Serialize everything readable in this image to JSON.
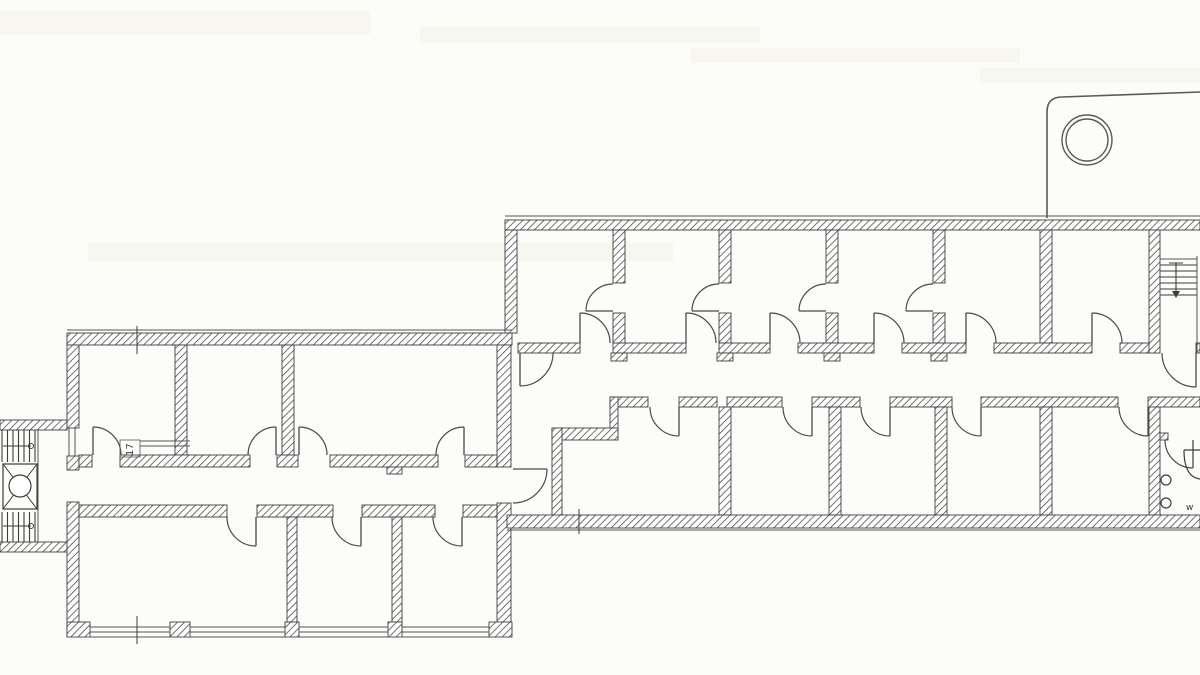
{
  "document": {
    "type": "architectural-floor-plan",
    "description": "Scanned black-and-white building floor plan with two office wings, central corridors, door swings, two stairwells, an elevator, a WC and an entrance canopy with column"
  },
  "labels": {
    "room_number": "17",
    "wc": "w"
  },
  "colors": {
    "background": "#fcfcf9",
    "wall_stroke": "#3d3d3d",
    "hatch": "#4d4d4d",
    "door": "#4a4a4a",
    "thin_line": "#555555",
    "canopy": "#5a5a5a",
    "streak": "#f3f1e8"
  },
  "plan": {
    "canvas": {
      "w": 1200,
      "h": 675
    },
    "streaks": [
      [
        0,
        10,
        370,
        24
      ],
      [
        420,
        26,
        340,
        16
      ],
      [
        88,
        243,
        585,
        18
      ],
      [
        690,
        48,
        330,
        15
      ],
      [
        980,
        68,
        220,
        14
      ]
    ],
    "walls": [
      [
        67,
        333,
        445,
        12
      ],
      [
        67,
        345,
        12,
        83
      ],
      [
        67,
        456,
        12,
        14
      ],
      [
        67,
        502,
        12,
        135
      ],
      [
        497,
        345,
        14,
        122
      ],
      [
        497,
        503,
        14,
        134
      ],
      [
        175,
        345,
        12,
        110
      ],
      [
        282,
        345,
        12,
        110
      ],
      [
        79,
        455,
        13,
        12
      ],
      [
        120,
        455,
        130,
        12
      ],
      [
        277,
        455,
        21,
        12
      ],
      [
        330,
        455,
        108,
        12
      ],
      [
        465,
        455,
        32,
        12
      ],
      [
        387,
        467,
        15,
        7
      ],
      [
        79,
        505,
        148,
        12
      ],
      [
        257,
        505,
        76,
        12
      ],
      [
        362,
        505,
        73,
        12
      ],
      [
        463,
        505,
        34,
        12
      ],
      [
        287,
        517,
        10,
        105
      ],
      [
        392,
        517,
        10,
        105
      ],
      [
        67,
        622,
        23,
        15
      ],
      [
        170,
        622,
        20,
        15
      ],
      [
        285,
        622,
        14,
        15
      ],
      [
        388,
        622,
        14,
        15
      ],
      [
        489,
        622,
        23,
        15
      ],
      [
        0,
        420,
        67,
        10
      ],
      [
        0,
        542,
        67,
        10
      ],
      [
        505,
        220,
        695,
        10
      ],
      [
        505,
        230,
        12,
        103
      ],
      [
        613,
        230,
        12,
        53
      ],
      [
        613,
        313,
        12,
        30
      ],
      [
        719,
        230,
        12,
        53
      ],
      [
        719,
        313,
        12,
        30
      ],
      [
        826,
        230,
        12,
        53
      ],
      [
        826,
        313,
        12,
        30
      ],
      [
        933,
        230,
        12,
        53
      ],
      [
        933,
        313,
        12,
        30
      ],
      [
        1040,
        230,
        12,
        113
      ],
      [
        1149,
        230,
        11,
        123
      ],
      [
        518,
        343,
        62,
        10
      ],
      [
        613,
        343,
        73,
        10
      ],
      [
        719,
        343,
        51,
        10
      ],
      [
        798,
        343,
        76,
        10
      ],
      [
        902,
        343,
        64,
        10
      ],
      [
        994,
        343,
        98,
        10
      ],
      [
        1120,
        343,
        29,
        10
      ],
      [
        1196,
        343,
        4,
        10
      ],
      [
        611,
        353,
        16,
        8
      ],
      [
        717,
        353,
        16,
        8
      ],
      [
        824,
        353,
        16,
        8
      ],
      [
        931,
        353,
        16,
        8
      ],
      [
        610,
        397,
        38,
        10
      ],
      [
        679,
        397,
        38,
        10
      ],
      [
        727,
        397,
        55,
        10
      ],
      [
        812,
        397,
        48,
        10
      ],
      [
        890,
        397,
        62,
        10
      ],
      [
        981,
        397,
        137,
        10
      ],
      [
        1148,
        397,
        52,
        10
      ],
      [
        610,
        397,
        8,
        33
      ],
      [
        552,
        428,
        66,
        12
      ],
      [
        552,
        428,
        10,
        99
      ],
      [
        719,
        407,
        12,
        108
      ],
      [
        829,
        407,
        12,
        108
      ],
      [
        935,
        407,
        12,
        108
      ],
      [
        1040,
        407,
        12,
        108
      ],
      [
        1149,
        407,
        11,
        108
      ],
      [
        507,
        515,
        693,
        13
      ],
      [
        1160,
        433,
        8,
        7
      ]
    ],
    "lines": [
      [
        67,
        330,
        512,
        330
      ],
      [
        67,
        637,
        512,
        637
      ],
      [
        90,
        627,
        170,
        627
      ],
      [
        190,
        627,
        285,
        627
      ],
      [
        299,
        627,
        388,
        627
      ],
      [
        402,
        627,
        489,
        627
      ],
      [
        90,
        632,
        170,
        632
      ],
      [
        190,
        632,
        285,
        632
      ],
      [
        299,
        632,
        388,
        632
      ],
      [
        402,
        632,
        489,
        632
      ],
      [
        69,
        428,
        69,
        456
      ],
      [
        75,
        428,
        75,
        456
      ],
      [
        140,
        441,
        190,
        441
      ],
      [
        140,
        446,
        190,
        446
      ],
      [
        505,
        216,
        1200,
        216
      ],
      [
        507,
        530,
        1200,
        530
      ],
      [
        1197,
        256,
        1197,
        352
      ],
      [
        1160,
        259,
        1197,
        259
      ],
      [
        38,
        430,
        38,
        542
      ]
    ],
    "ticks": [
      [
        137,
        326,
        137,
        354
      ],
      [
        137,
        616,
        137,
        644
      ],
      [
        579,
        509,
        579,
        534
      ]
    ],
    "doors": [
      [
        93,
        455,
        93,
        427,
        121,
        455,
        1
      ],
      [
        276,
        455,
        276,
        427,
        248,
        455,
        0
      ],
      [
        299,
        455,
        299,
        427,
        327,
        455,
        1
      ],
      [
        464,
        455,
        464,
        427,
        436,
        455,
        0
      ],
      [
        256,
        517,
        256,
        546,
        227,
        517,
        1
      ],
      [
        361,
        517,
        361,
        546,
        332,
        517,
        1
      ],
      [
        462,
        517,
        462,
        546,
        433,
        517,
        1
      ],
      [
        513,
        469,
        547,
        469,
        513,
        503,
        1
      ],
      [
        580,
        343,
        580,
        313,
        610,
        343,
        1
      ],
      [
        686,
        343,
        686,
        313,
        716,
        343,
        1
      ],
      [
        770,
        343,
        770,
        313,
        800,
        343,
        1
      ],
      [
        874,
        343,
        874,
        313,
        904,
        343,
        1
      ],
      [
        966,
        343,
        966,
        313,
        996,
        343,
        1
      ],
      [
        1092,
        343,
        1092,
        313,
        1122,
        343,
        1
      ],
      [
        613,
        311,
        586,
        311,
        613,
        284,
        1
      ],
      [
        719,
        311,
        692,
        311,
        719,
        284,
        1
      ],
      [
        826,
        311,
        799,
        311,
        826,
        284,
        1
      ],
      [
        933,
        311,
        906,
        311,
        933,
        284,
        1
      ],
      [
        679,
        407,
        679,
        436,
        650,
        407,
        1
      ],
      [
        812,
        407,
        812,
        436,
        783,
        407,
        1
      ],
      [
        890,
        407,
        890,
        436,
        861,
        407,
        1
      ],
      [
        981,
        407,
        981,
        436,
        952,
        407,
        1
      ],
      [
        1148,
        407,
        1148,
        436,
        1119,
        407,
        1
      ],
      [
        520,
        353,
        520,
        386,
        553,
        353,
        0
      ],
      [
        1196,
        353,
        1196,
        387,
        1162,
        353,
        1
      ],
      [
        1193,
        440,
        1193,
        468,
        1165,
        440,
        1
      ]
    ],
    "stairs_west": {
      "tread_x": [
        2,
        7.5,
        13,
        18.5,
        24,
        29.5,
        35
      ],
      "flight1_y": [
        430,
        462
      ],
      "flight2_y": [
        512,
        542
      ],
      "guide1": [
        3,
        446,
        31,
        446
      ],
      "guide2": [
        3,
        526,
        31,
        526
      ],
      "guide_dot_r": 2.5
    },
    "elevator": {
      "rect": [
        3,
        464,
        34,
        45
      ],
      "circle": [
        20,
        486,
        11
      ]
    },
    "stairs_ne": {
      "tread_y": [
        265,
        271,
        277,
        283,
        289,
        295
      ],
      "tread_x": [
        1160,
        1197
      ],
      "arrow": [
        1176,
        263,
        1176,
        298
      ],
      "arrow_tail": [
        1169,
        263,
        1183,
        263
      ]
    },
    "canopy": {
      "path": "M 1047 218 L 1047 112 Q 1047 97 1062 97 L 1200 92",
      "column_circles": [
        [
          1087,
          140,
          25
        ],
        [
          1087,
          140,
          21
        ]
      ]
    },
    "wc": {
      "sink_path": "M 1184 450 L 1200 450 M 1184 450 Q 1184 477 1200 479",
      "circles": [
        [
          1166,
          480,
          5
        ],
        [
          1166,
          503,
          5
        ]
      ]
    },
    "texts": [
      {
        "key": "labels.room_number",
        "x": 133,
        "y": 456,
        "size": 10,
        "rotate": -90,
        "boxed": [
          120,
          440,
          20,
          17
        ]
      },
      {
        "key": "labels.wc",
        "x": 1186,
        "y": 510,
        "size": 9,
        "rotate": 0
      }
    ]
  }
}
